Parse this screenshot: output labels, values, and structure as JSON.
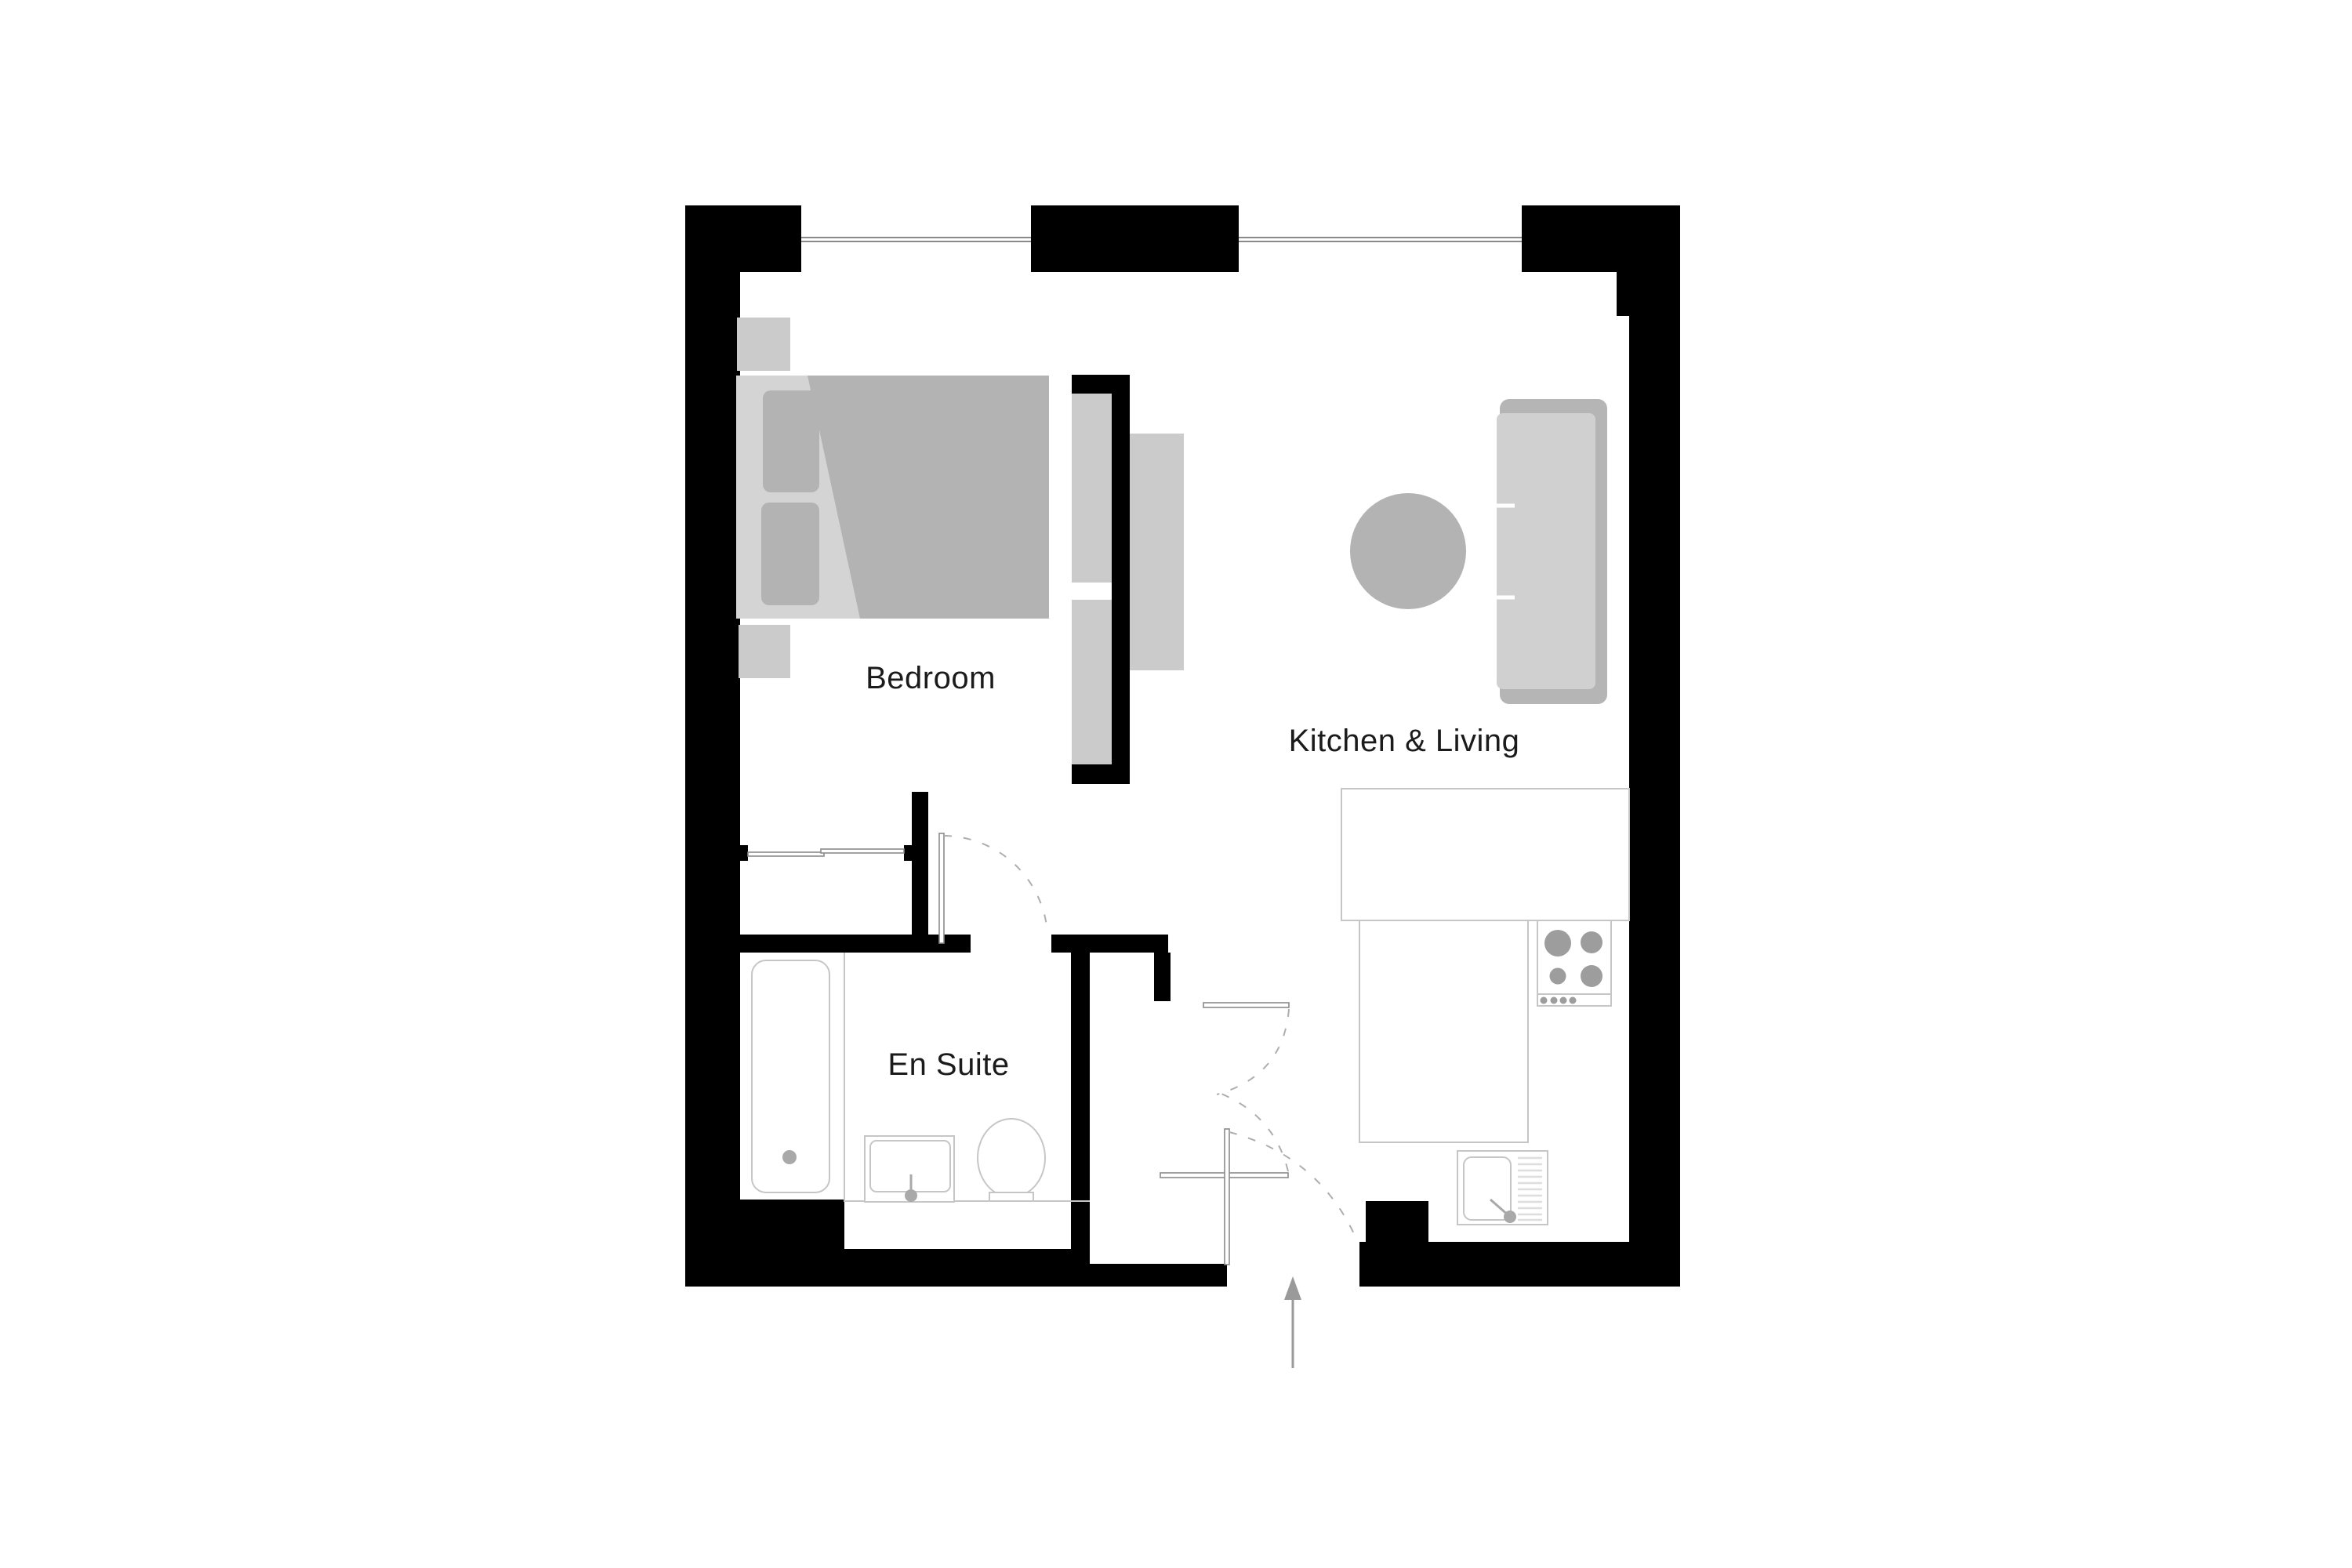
{
  "title": "Apartment floor plan",
  "rooms": {
    "bedroom": {
      "label": "Bedroom"
    },
    "kitchen_living": {
      "label": "Kitchen & Living"
    },
    "en_suite": {
      "label": "En Suite"
    }
  },
  "fixtures": {
    "bedroom": [
      "bed",
      "pillows",
      "nightstand-top",
      "nightstand-bottom",
      "wardrobe-sliding-doors",
      "partition-shelf",
      "tv-panel"
    ],
    "kitchen_living": [
      "sofa",
      "coffee-table",
      "kitchen-counter-l-shape",
      "hob-4-burners",
      "kitchen-sink-with-drainer"
    ],
    "en_suite": [
      "bathtub",
      "wash-basin",
      "toilet"
    ]
  },
  "doors": [
    "en-suite-door",
    "hall-door-upper",
    "hall-door-lower",
    "entry-door"
  ],
  "windows": [
    "top-wall-window-left",
    "top-wall-window-right"
  ],
  "entry": {
    "direction": "up",
    "symbol": "entry-arrow"
  },
  "colors": {
    "wall": "#000000",
    "furniture_mid": "#b3b3b3",
    "furniture_light": "#cbcbcb",
    "bed_base": "#d4d4d4",
    "outline": "#c6c6c6",
    "burner": "#9d9d9d",
    "label_text": "#1b1b1b",
    "door_arc": "#aeaeae",
    "background": "#ffffff"
  }
}
